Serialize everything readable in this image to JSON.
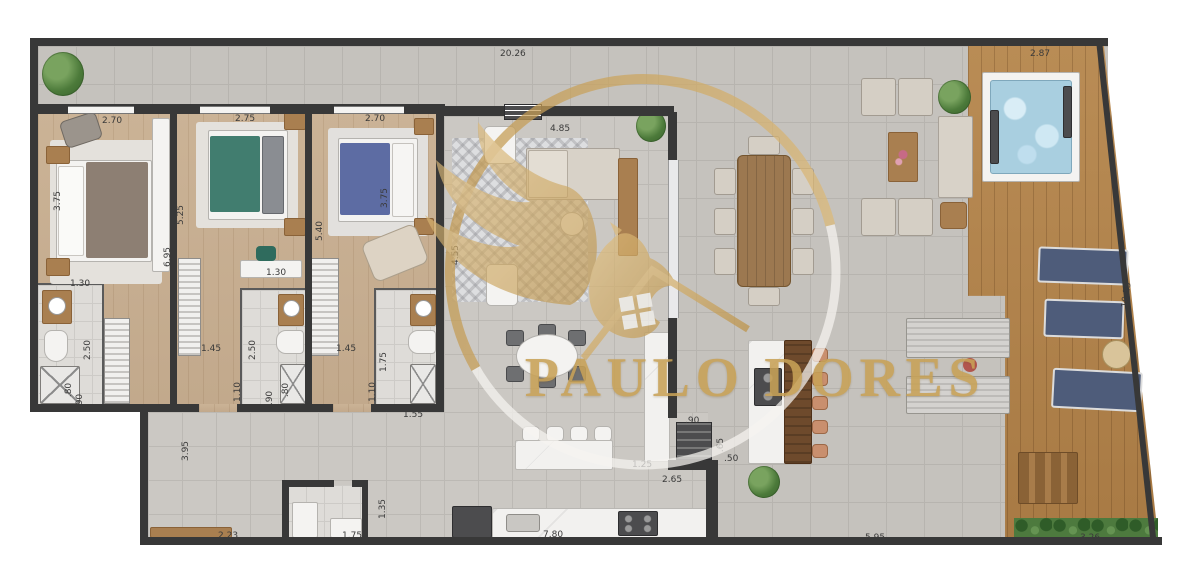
{
  "watermark": {
    "brand": "PAULO DORES"
  },
  "colors": {
    "brand_gold": "#c8a257",
    "wall": "#383838",
    "deck_wood": "#ac7c46",
    "bedroom_wood": "#c7ae90",
    "tile_indoor": "#cbc8c3",
    "tile_outdoor": "#c5c2bd",
    "lounger_navy": "#4e5c7a",
    "bed_teal": "#417d6f",
    "bed_blue": "#5d6ca3",
    "bed_taupe": "#8d7f73",
    "hot_tub_water": "#a9cfe0",
    "hedge_green": "#4d7a3e"
  },
  "dimension_labels": [
    {
      "text": "20.26",
      "x": 500,
      "y": 49,
      "rot": 0
    },
    {
      "text": "2.87",
      "x": 1030,
      "y": 49,
      "rot": 0
    },
    {
      "text": "2.70",
      "x": 102,
      "y": 116,
      "rot": 0
    },
    {
      "text": "2.75",
      "x": 235,
      "y": 114,
      "rot": 0
    },
    {
      "text": "2.70",
      "x": 365,
      "y": 114,
      "rot": 0
    },
    {
      "text": "4.85",
      "x": 550,
      "y": 124,
      "rot": 0
    },
    {
      "text": "3.75",
      "x": 48,
      "y": 196,
      "rot": -90
    },
    {
      "text": "5.25",
      "x": 171,
      "y": 210,
      "rot": -90
    },
    {
      "text": "6.95",
      "x": 158,
      "y": 252,
      "rot": -90
    },
    {
      "text": "5.40",
      "x": 310,
      "y": 226,
      "rot": -90
    },
    {
      "text": "3.75",
      "x": 375,
      "y": 193,
      "rot": -90
    },
    {
      "text": "4.55",
      "x": 446,
      "y": 250,
      "rot": -90
    },
    {
      "text": "1.30",
      "x": 70,
      "y": 279,
      "rot": 0
    },
    {
      "text": "1.30",
      "x": 266,
      "y": 268,
      "rot": 0
    },
    {
      "text": "1.45",
      "x": 201,
      "y": 344,
      "rot": 0
    },
    {
      "text": "1.45",
      "x": 336,
      "y": 344,
      "rot": 0
    },
    {
      "text": "2.50",
      "x": 78,
      "y": 345,
      "rot": -90
    },
    {
      "text": "2.50",
      "x": 243,
      "y": 345,
      "rot": -90
    },
    {
      "text": "1.75",
      "x": 374,
      "y": 357,
      "rot": -90
    },
    {
      "text": "1.10",
      "x": 228,
      "y": 387,
      "rot": -90
    },
    {
      "text": "1.10",
      "x": 363,
      "y": 387,
      "rot": -90
    },
    {
      "text": ".80",
      "x": 62,
      "y": 385,
      "rot": -90
    },
    {
      "text": ".90",
      "x": 73,
      "y": 396,
      "rot": -90
    },
    {
      "text": ".90",
      "x": 263,
      "y": 393,
      "rot": -90
    },
    {
      "text": ".80",
      "x": 279,
      "y": 385,
      "rot": -90
    },
    {
      "text": "1.55",
      "x": 403,
      "y": 410,
      "rot": 0
    },
    {
      "text": "3.95",
      "x": 176,
      "y": 446,
      "rot": -90
    },
    {
      "text": "2.23",
      "x": 218,
      "y": 531,
      "rot": 0
    },
    {
      "text": "1.35",
      "x": 373,
      "y": 504,
      "rot": -90
    },
    {
      "text": "1.75",
      "x": 342,
      "y": 531,
      "rot": 0
    },
    {
      "text": "7.80",
      "x": 543,
      "y": 530,
      "rot": 0
    },
    {
      "text": "1.25",
      "x": 632,
      "y": 460,
      "rot": 0
    },
    {
      "text": "2.65",
      "x": 662,
      "y": 475,
      "rot": 0
    },
    {
      "text": ".90",
      "x": 685,
      "y": 416,
      "rot": 0
    },
    {
      "text": ".65",
      "x": 714,
      "y": 440,
      "rot": -90
    },
    {
      "text": ".50",
      "x": 724,
      "y": 454,
      "rot": 0
    },
    {
      "text": "5.95",
      "x": 865,
      "y": 533,
      "rot": 0
    },
    {
      "text": "3.26",
      "x": 1080,
      "y": 533,
      "rot": 0
    },
    {
      "text": "10.15",
      "x": 1114,
      "y": 290,
      "rot": -82
    }
  ]
}
